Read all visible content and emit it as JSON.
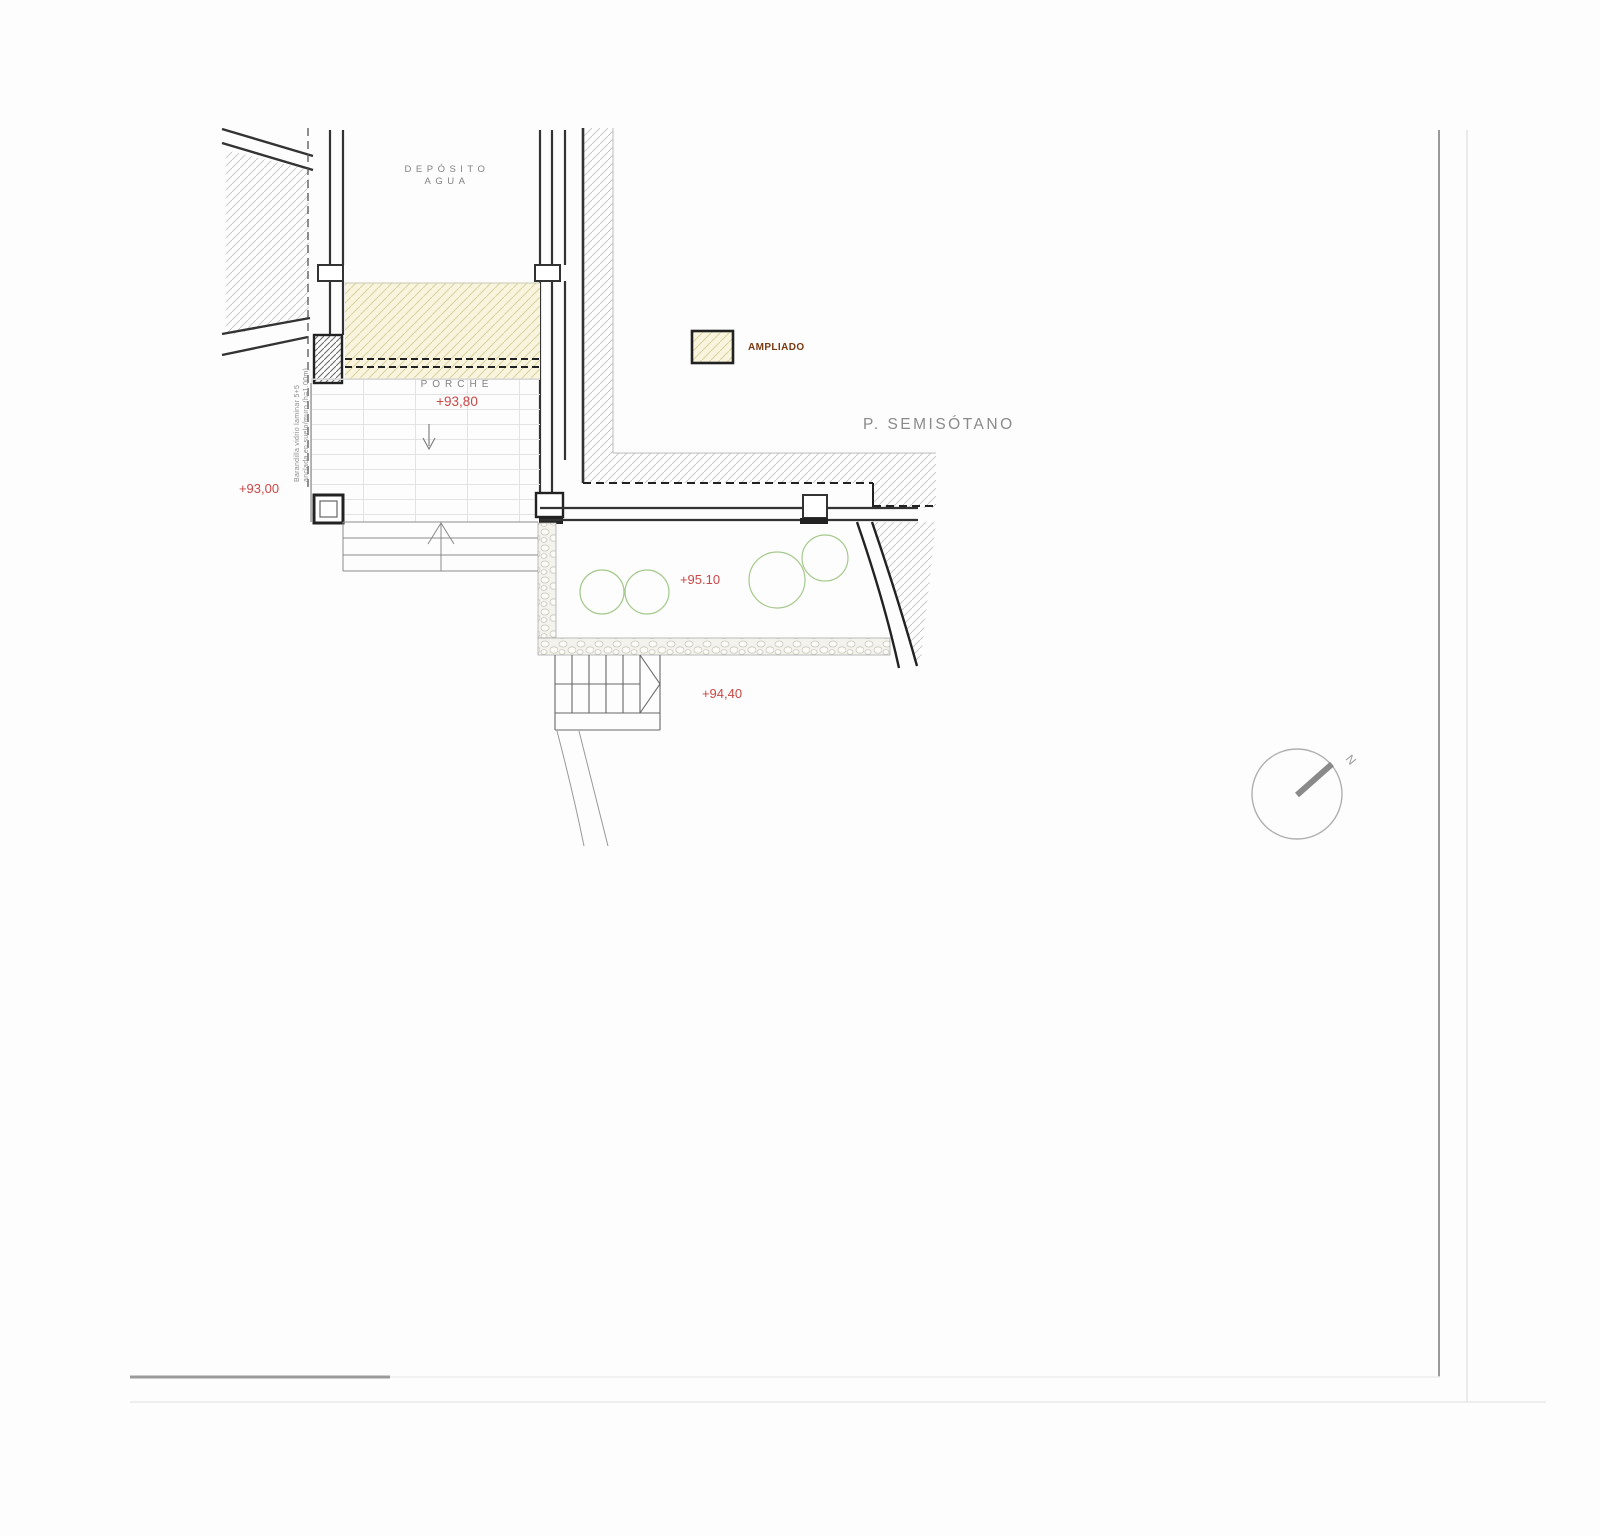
{
  "drawing": {
    "title": "site-plan-semisotano",
    "labels": {
      "deposito_line1": "DEPÓSITO",
      "deposito_line2": "AGUA",
      "porche": "PORCHE",
      "porche_level": "+93,80",
      "level_93": "+93,00",
      "level_95": "+95.10",
      "level_94": "+94,40",
      "semisotano": "P. SEMISÓTANO",
      "ampliado": "AMPLIADO",
      "barandilla_line1": "Barandilla vidrio laminar 5+5",
      "barandilla_line2": "anclada en suelo/muro (h=1.00m)",
      "north": "N"
    },
    "colors": {
      "red_level": "#c94744",
      "ampliado_text": "#7a3b12",
      "yellow_fill": "#f8f4dd",
      "yellow_hatch_line": "#ddd3a3",
      "tree_green": "#a5c98c",
      "wall_dark": "#2f2f2f",
      "gray_text": "#8a8a8a",
      "hatch_gray": "#c4c4c4",
      "border_gray": "#9a9a9a"
    }
  }
}
